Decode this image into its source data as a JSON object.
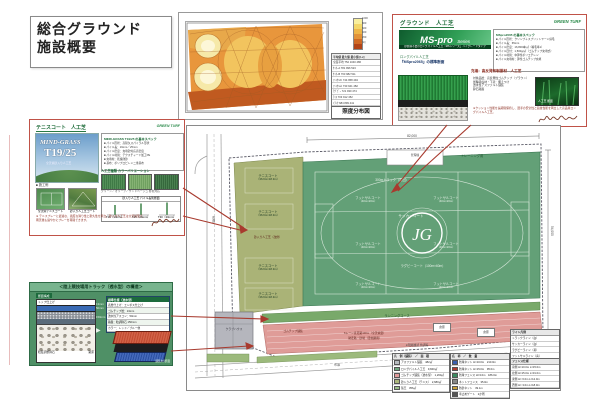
{
  "page": {
    "title_line1": "総合グラウンド",
    "title_line2": "施設概要"
  },
  "heatmap": {
    "caption": "照度分布図",
    "legend_ticks": [
      "1000",
      "800",
      "600",
      "400",
      "200",
      "[lx]"
    ],
    "table_header": "平均値 最大値 最小値 [Lx]",
    "table_rows": [
      "全面平均  752 1040 486",
      "ｻｯｶｰA  781  996 523",
      "ｻｯｶｰB  763  982 511",
      "ﾌｯﾄｻﾙ①  744  958 494",
      "ﾌｯﾄｻﾙ②  733  941 482",
      "ﾗｸﾞﾋﾞｰ  721  930 474",
      "ﾃﾆｽ  703  912 452",
      "ﾄﾗｯｸ  684  899 441"
    ]
  },
  "ground_box": {
    "header": "グラウンド　人工芝",
    "logo": "GREEN TURF",
    "series_name": "MS-pro",
    "series_suffix": "Series",
    "series_tagline": "砂充填不要のロングパイル人工芝『MSシリーズ』ハイグレードタイプ",
    "spec_title": "MSpro2065 の基本スペック",
    "specs": [
      "■ パイル形状：クリンプ＋スプリットヤーン併毛",
      "■ パイル長：65mm",
      "■ パイル密度：16,800本/㎡（輸毛率1）",
      "■ パイル目付：1,500g/㎡（ゴムチップ充填式）",
      "■ パイル材質：中弾性ポリエチレン",
      "■ パイル充填材：弾性ゴムチップ充填"
    ],
    "section_note1": "ロングパイル人工芝",
    "section_note2": "『MSpro2065』の標準断面",
    "fill_label": "充填：高反発有制振材　人工芝",
    "right_specs": [
      "対象品層：高反発性ゴムチップ（ブラウン）",
      "衝撃吸収材・下塗：備えつけ",
      "透水性アスファルト舗装",
      "砕石路盤"
    ],
    "photo_caption": "人工芝 断面",
    "bottom_note": "※クッション性能を長期間保持し、選手の安全性と競技性能を両立した高品質ロングパイル人工芝。"
  },
  "tennis_box": {
    "header": "テニスコート　人工芝",
    "logo": "GREEN TURF",
    "brand": "MIND-GRASS",
    "model": "T19/25",
    "brand_sub": "全天候砂入り人工芝",
    "spec_title": "MIND-GRASS T19/25 の基本スペック",
    "specs": [
      "■ パイル形状：高耐久スパイラル形状",
      "■ パイル長：19mm／25mm",
      "■ パイル密度：充填砂対応高密度",
      "■ パイル材質：テクスチャード加工PE",
      "■ 充填材：乾燥硅砂",
      "■ 基布：ポリプロピレン二重基布"
    ],
    "swatch_title": "人工芝種類 カラーバリエーション",
    "swatch_caption": "グリーン／オリーブ／サンドベージュ 各色対応",
    "photos_title": "■ 施工例",
    "photo_cap1": "全天候テニスコート",
    "photo_cap2": "砂入り人工芝コート",
    "diagram_title": "砂入り人工芝 パイル長別断面",
    "diagram_items": [
      "T19（19mm）",
      "T25（25mm）",
      "T30（30mm）"
    ],
    "note": "※ テニスプレーに最適な、適度な滑り性と耐久性を両立。砂入り人工芝は全天候型で、雨天後も速やかにプレーを再開できます。"
  },
  "track_box": {
    "title": "＜陸上競技場用トラック（透水型）の構造＞",
    "section_tab": "断面構成",
    "layers": [
      "トップ仕上げ",
      "ゴムチップ層",
      "透水性アスコン",
      "粒度調整砕石",
      "路床"
    ],
    "dims": [
      "13mm",
      "50mm",
      "150mm"
    ],
    "table_title": "標準仕様（透水型）",
    "table_rows": [
      "表層仕上げ：エンボス仕上げ",
      "ゴムチップ層：13mm",
      "透水性アスコン：50mm",
      "路盤：粒調砕石 150mm",
      "カラー：レッド／ブルー他"
    ],
    "image_caption": "舗装材 断面"
  },
  "plan": {
    "dim_top": "82,000",
    "dim_right": "54,000",
    "road_left": "市道",
    "road_bottom": "市道",
    "tennis_court_name": "テニスコート",
    "tennis_court_size": "（36.6m×18.3m）",
    "tennis_note": "砂入り人工芝（改修）",
    "training_label": "トレーニング用",
    "building_top": "管理棟",
    "building_side": "クラブハウス",
    "track300": "300mトラック（周回）",
    "soccer": "サッカーコート",
    "futsal_name": "フットサルコート",
    "futsal_size": "（40m×20m）",
    "rugby": "ラグビーコート（100m×60m）",
    "running": "ランニングコース",
    "track_material": "ゴムチップ舗装",
    "track_note1": "6レーン直走路100m（全天候型）",
    "track_note2": "助走路・砂場（走幅跳用）",
    "storage": "倉庫",
    "site_note": "※現場確認 色調等",
    "legend_materials": {
      "title": "凡　例（舗装）　／　面　積",
      "rows": [
        {
          "color": "#b8bcc0",
          "label": "アスファルト舗装",
          "value": "482㎡"
        },
        {
          "color": "#6fa87e",
          "label": "ロングパイル人工芝",
          "value": "9,840㎡"
        },
        {
          "color": "#e09a9a",
          "label": "ゴムチップ舗装（透水型）",
          "value": "1,260㎡"
        },
        {
          "color": "#adb87c",
          "label": "砂入り人工芝（テニス）",
          "value": "2,680㎡"
        },
        {
          "color": "#9cc08a",
          "label": "張芝",
          "value": "356㎡"
        }
      ]
    },
    "legend_nets": {
      "title": "名　称　／　数　量",
      "rows": [
        {
          "color": "#3a5fae",
          "label": "防球ネット H=10.0m",
          "value": "210.0m"
        },
        {
          "color": "#b03a2e",
          "label": "防球ネット H=15.0m",
          "value": "95.0m"
        },
        {
          "color": "#3a8a5f",
          "label": "防球フェンス H=3.0m",
          "value": "186.0m"
        },
        {
          "color": "#888888",
          "label": "ネットフェンス",
          "value": "35.0m"
        },
        {
          "color": "#c8a03a",
          "label": "防砂ネット",
          "value": "39.1m"
        },
        {
          "color": "#555555",
          "label": "車止めゲート",
          "value": "2か所"
        }
      ]
    },
    "line_legend": {
      "title": "ライン凡例",
      "rows": [
        "トラックライン（白）",
        "サッカーライン（白）",
        "ラグビーライン（黄）",
        "フットサルライン（青）",
        "テニスライン（白）"
      ]
    },
    "fence_table": {
      "title": "フェンス仕様",
      "rows": [
        "南側 H=10.0m L=15.0m",
        "北側 H=15.0m L=31.0m",
        "東側 H= 6.0m L=12.0m",
        "西側 H= 3.0m L=18.0m"
      ]
    },
    "center_logo": "JG"
  }
}
